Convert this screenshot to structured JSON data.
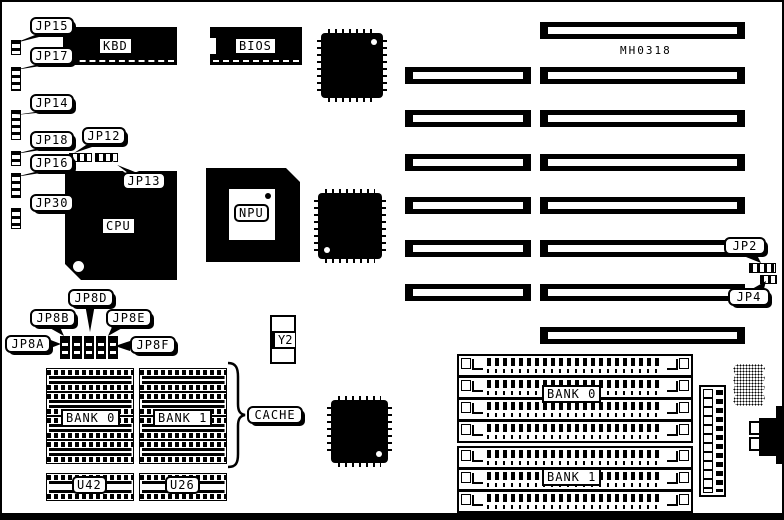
{
  "board": {
    "model": "MH0318"
  },
  "colors": {
    "ink": "#000000",
    "paper": "#ffffff"
  },
  "jumpers": {
    "jp15": "JP15",
    "jp17": "JP17",
    "jp14": "JP14",
    "jp12": "JP12",
    "jp18": "JP18",
    "jp16": "JP16",
    "jp13": "JP13",
    "jp30": "JP30",
    "jp8a": "JP8A",
    "jp8b": "JP8B",
    "jp8d": "JP8D",
    "jp8e": "JP8E",
    "jp8f": "JP8F",
    "jp2": "JP2",
    "jp4": "JP4"
  },
  "chips": {
    "kbd": "KBD",
    "bios": "BIOS",
    "cpu": "CPU",
    "npu": "NPU",
    "y2": "Y2",
    "cache": "CACHE",
    "u42": "U42",
    "u26": "U26"
  },
  "dram": {
    "bank0": "BANK 0",
    "bank1": "BANK 1"
  },
  "simm": {
    "bank0": "BANK 0",
    "bank1": "BANK 1"
  }
}
